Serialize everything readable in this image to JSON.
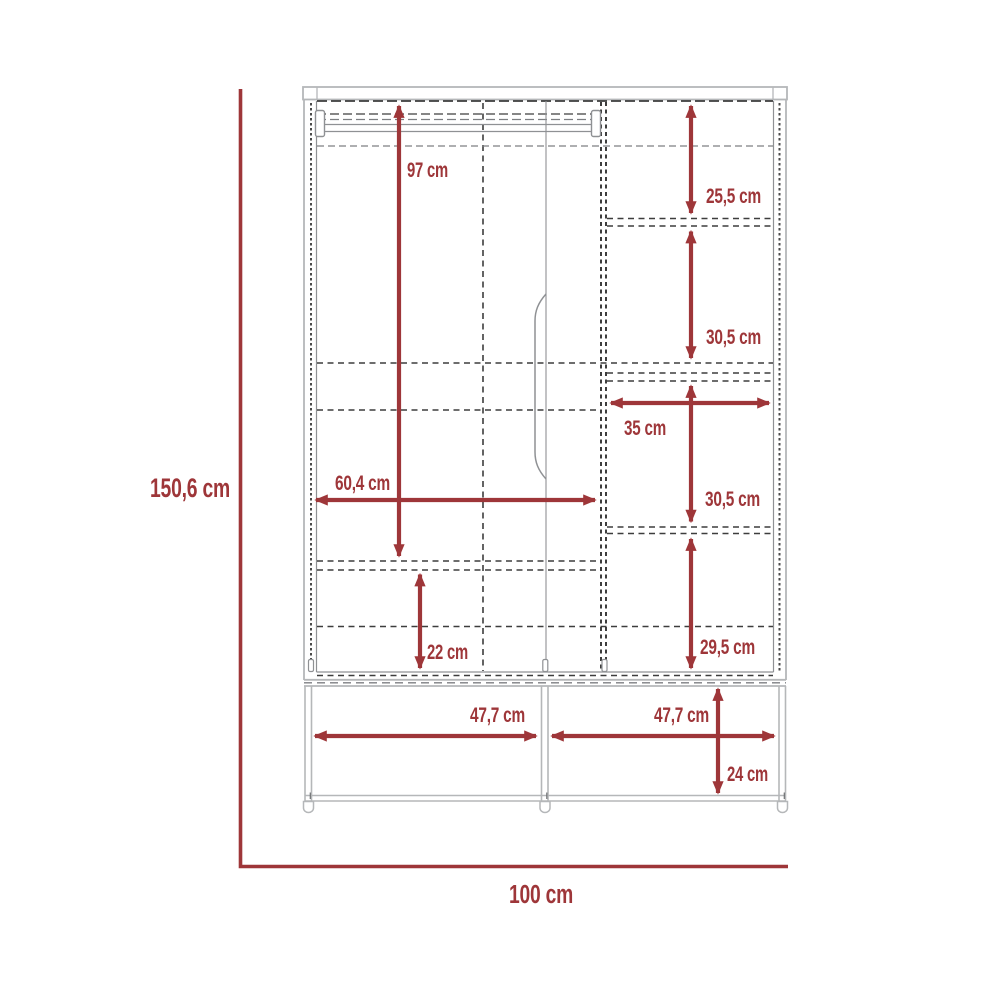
{
  "diagram": {
    "kind": "wardrobe dimension drawing",
    "unit": "cm",
    "overall": {
      "height_label": "150,6 cm",
      "width_label": "100 cm"
    }
  },
  "labels": {
    "hanging_space_height": "97 cm",
    "right_compartment_1_height": "25,5 cm",
    "right_compartment_2_height": "30,5 cm",
    "right_compartment_width": "35 cm",
    "right_compartment_3_height": "30,5 cm",
    "right_compartment_4_height": "29,5 cm",
    "left_compartment_width": "60,4 cm",
    "left_bottom_compartment_height": "22 cm",
    "base_left_opening_width": "47,7 cm",
    "base_right_opening_width": "47,7 cm",
    "base_height": "24 cm"
  },
  "colors": {
    "dimension_red": "#9e3639",
    "panel_light_gray": "#b5b7b9",
    "detail_mid_gray": "#8f9194",
    "hidden_edge_dark": "#3d3d3d",
    "background": "#ffffff"
  }
}
